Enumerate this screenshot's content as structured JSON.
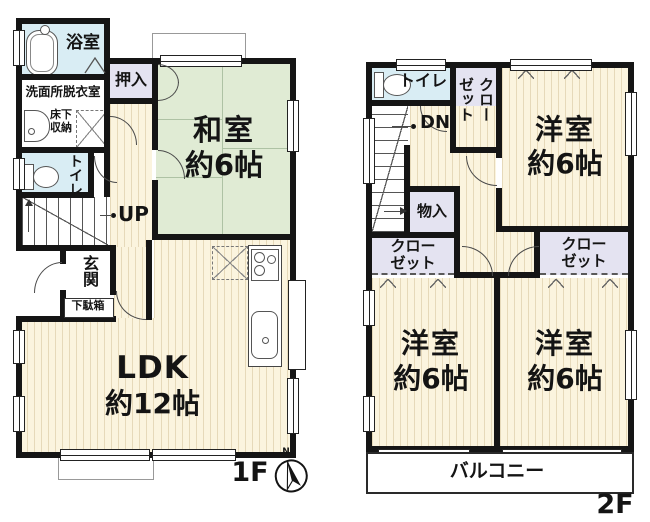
{
  "floor1": {
    "label": "1F",
    "bathroom": "浴室",
    "washroom": "洗面所脱衣室",
    "underfloor_storage": "床下収納",
    "toilet": "トイレ",
    "oshiire": "押入",
    "washitsu": "和室",
    "washitsu_size": "約6帖",
    "stairs_up": "UP",
    "entrance": "玄関",
    "shoe_cabinet": "下駄箱",
    "ldk": "LDK",
    "ldk_size": "約12帖"
  },
  "floor2": {
    "label": "2F",
    "toilet": "トイレ",
    "closet_upper": "クローゼット",
    "stairs_down": "DN",
    "storage": "物入",
    "closet_left": "クローゼット",
    "closet_right": "クローゼット",
    "bedroom_ne": "洋室",
    "bedroom_ne_size": "約6帖",
    "bedroom_sw": "洋室",
    "bedroom_sw_size": "約6帖",
    "bedroom_se": "洋室",
    "bedroom_se_size": "約6帖",
    "balcony": "バルコニー"
  },
  "compass": {
    "north": "N"
  },
  "colors": {
    "wall": "#151515",
    "wood_floor": "#fbf4de",
    "tatami": "#e0ebd4",
    "wet_area": "#d9edf4",
    "closet": "#e4e3f1",
    "text": "#141414"
  }
}
